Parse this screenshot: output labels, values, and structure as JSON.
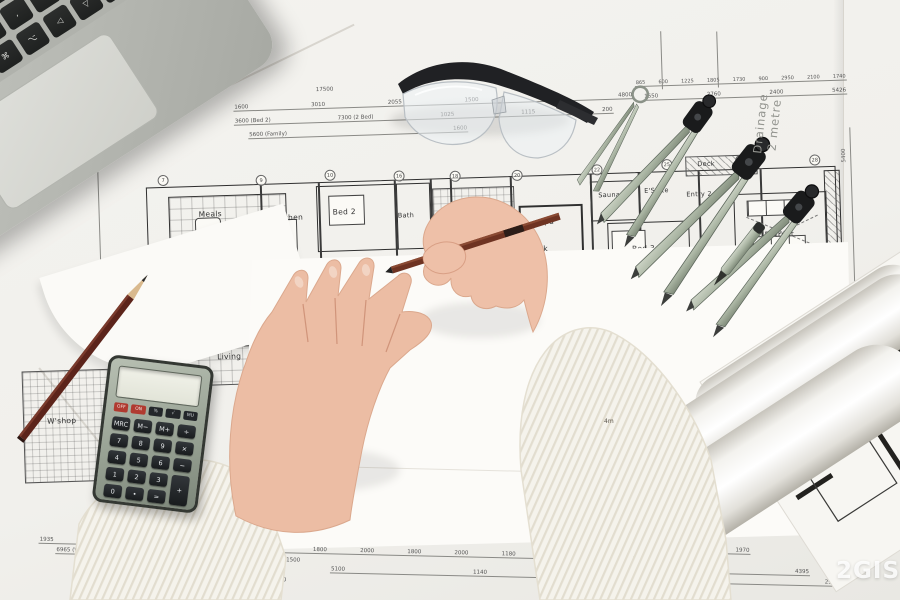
{
  "watermark": "2GIS",
  "notes": {
    "drainage_line1": "Drainage",
    "drainage_line2": "2 metre",
    "scale": "4m",
    "vertical_dim": "5400"
  },
  "blueprint": {
    "rooms": [
      {
        "label": "Meals"
      },
      {
        "label": "Kitchen"
      },
      {
        "label": "Bed 2"
      },
      {
        "label": "Bath"
      },
      {
        "label": "Spa"
      },
      {
        "label": "Deck"
      },
      {
        "label": "Sauna"
      },
      {
        "label": "E'Suite"
      },
      {
        "label": "Entry 2"
      },
      {
        "label": "Deck"
      },
      {
        "label": "Bed 3"
      },
      {
        "label": "Retreat"
      },
      {
        "label": "Patio"
      },
      {
        "label": "Deck"
      },
      {
        "label": "Entry"
      },
      {
        "label": "Deck"
      },
      {
        "label": "Living"
      },
      {
        "label": "Family"
      },
      {
        "label": "W'shop"
      },
      {
        "label": "Porte coch."
      }
    ],
    "dims": {
      "top_total": [
        "17500"
      ],
      "top_a": [
        "1600",
        "3010",
        "2055",
        "1500",
        "1600",
        "4800"
      ],
      "top_b": [
        "3600 (Bed 2)",
        "7300 (2 Bed)",
        "1025",
        "1115",
        "200"
      ],
      "top_c": [
        "5600 (Family)",
        "1600"
      ],
      "top_r1": [
        "865",
        "600",
        "1225",
        "1805",
        "1730",
        "900",
        "2950",
        "2100",
        "1740"
      ],
      "top_r2": [
        "1550",
        "2760",
        "2400",
        "5426"
      ],
      "bot_l1": [
        "1935",
        "4800"
      ],
      "bot_l2": [
        "6965 (W'shop / Garage)"
      ],
      "bot_m1": [
        "(8300)",
        "1800",
        "2000",
        "1800",
        "2000",
        "1180",
        "200"
      ],
      "bot_m2": [
        "1500"
      ],
      "bot_m3": [
        "5100",
        "1140",
        "3090"
      ],
      "bot_m4": [
        "24180"
      ],
      "bot_r1": [
        "1390",
        "1970"
      ],
      "bot_r2": [
        "4420 (Bed 3)"
      ],
      "bot_r3": [
        "1390",
        "1800",
        "4395"
      ],
      "bot_r4": [
        "3690",
        "1200",
        "2949"
      ],
      "bot_r5": [
        "12560"
      ]
    },
    "grid_bubbles": [
      "7",
      "9",
      "10",
      "16",
      "18",
      "20",
      "22",
      "25",
      "27",
      "28"
    ]
  },
  "calculator": {
    "display": "",
    "small_keys": [
      "OFF",
      "ON",
      "%",
      "√",
      "MU"
    ],
    "keys": [
      "MRC",
      "M−",
      "M+",
      "÷",
      "7",
      "8",
      "9",
      "×",
      "4",
      "5",
      "6",
      "−",
      "1",
      "2",
      "3",
      "+",
      "0",
      "•",
      "="
    ]
  },
  "laptop": {
    "keys": [
      "`",
      "1",
      "2",
      "3",
      "4",
      "5",
      "6",
      "7",
      "8",
      "9",
      "0",
      "-",
      "=",
      "⌫",
      "⇥",
      "Q",
      "W",
      "E",
      "R",
      "T",
      "Y",
      "U",
      "I",
      "O",
      "P",
      "[",
      "]",
      "\\",
      "⇪",
      "A",
      "S",
      "D",
      "F",
      "G",
      "H",
      "J",
      "K",
      "L",
      ";",
      "'",
      "⏎",
      "",
      "⇧",
      "Z",
      "X",
      "C",
      "V",
      "B",
      "N",
      "M",
      ",",
      ".",
      "/",
      "⇧",
      "",
      "fn",
      "⌃",
      "⌥",
      "⌘",
      "",
      "",
      "",
      "",
      "⌘",
      "⌥",
      "◁",
      "▽",
      "▷",
      "",
      ""
    ]
  }
}
